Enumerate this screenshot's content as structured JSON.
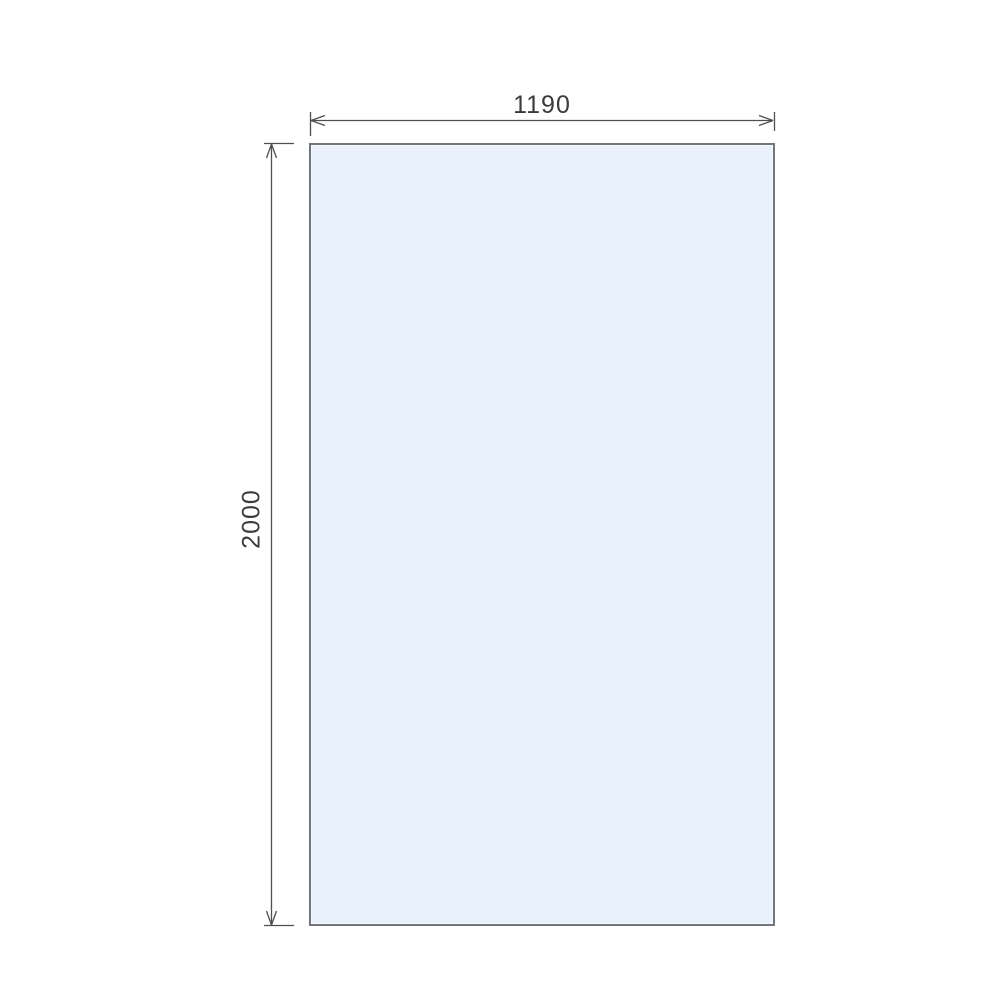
{
  "diagram": {
    "type": "technical-dimension-drawing",
    "subject": "rectangular glass panel front elevation",
    "panel": {
      "width_dimension_label": "1190",
      "height_dimension_label": "2000",
      "fill_color": "#e9f2fc",
      "border_color": "#70767b"
    },
    "dimension_style": {
      "line_color": "#4f4f4f",
      "text_color": "#3b3b3b",
      "arrow_type": "open-v",
      "width_label_position": "top-center-above-line",
      "height_label_position": "left-center-rotated-90ccw"
    }
  }
}
